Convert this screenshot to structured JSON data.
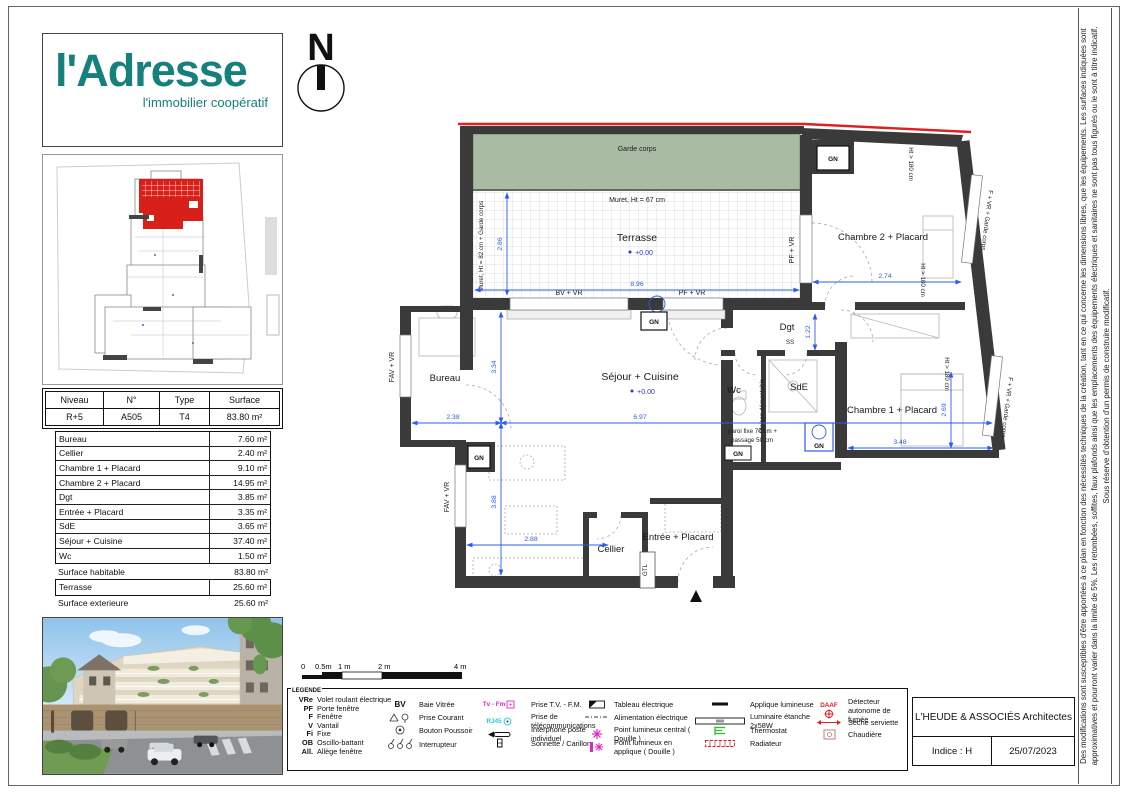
{
  "logo": {
    "name": "l'Adresse",
    "tagline": "l'immobilier coopératif"
  },
  "north_label": "N",
  "unit": {
    "headers": [
      "Niveau",
      "N°",
      "Type",
      "Surface"
    ],
    "values": [
      "R+5",
      "A505",
      "T4",
      "83.80 m²"
    ]
  },
  "areas": {
    "rows": [
      {
        "label": "Bureau",
        "value": "7.60 m²"
      },
      {
        "label": "Cellier",
        "value": "2.40 m²"
      },
      {
        "label": "Chambre 1 + Placard",
        "value": "9.10 m²"
      },
      {
        "label": "Chambre 2 + Placard",
        "value": "14.95 m²"
      },
      {
        "label": "Dgt",
        "value": "3.85 m²"
      },
      {
        "label": "Entrée + Placard",
        "value": "3.35 m²"
      },
      {
        "label": "SdE",
        "value": "3.65 m²"
      },
      {
        "label": "Séjour + Cuisine",
        "value": "37.40 m²"
      },
      {
        "label": "Wc",
        "value": "1.50 m²"
      }
    ],
    "habitable": {
      "label": "Surface habitable",
      "value": "83.80 m²"
    },
    "terrasse": {
      "label": "Terrasse",
      "value": "25.60 m²"
    },
    "exterieure": {
      "label": "Surface exterieure",
      "value": "25.60 m²"
    }
  },
  "plan": {
    "rooms": {
      "terrasse": "Terrasse",
      "sejour": "Séjour + Cuisine",
      "bureau": "Bureau",
      "chambre2": "Chambre 2 + Placard",
      "chambre1": "Chambre 1 + Placard",
      "dgt": "Dgt",
      "wc": "Wc",
      "sde": "SdE",
      "cellier": "Cellier",
      "entree": "Entrée + Placard"
    },
    "levels": {
      "terrasse": "+0.00",
      "sejour": "+0.00"
    },
    "annotations": {
      "garde_corps": "Garde corps",
      "muret67": "Muret, Ht = 67 cm",
      "muret82": "Muret, Ht = 82 cm + Garde corps",
      "bv_vr": "BV + VR",
      "pf_vr": "PF + VR",
      "fav_vr": "FAV + VR",
      "f_vr_gc": "F + VR + Garde corps",
      "ht180": "Ht > 180 cm",
      "gn": "GN",
      "gtl": "GTL",
      "ss": "SS",
      "cloison": "Cloison démontable",
      "paroi1": "paroi fixe 70 cm +",
      "paroi2": "passage 50 cm"
    },
    "dims": {
      "terrasse_h": "2.86",
      "terrasse_w": "8.96",
      "bureau_w": "2.38",
      "sejour_h1": "3.34",
      "sejour_w": "6.97",
      "sejour_h2": "3.88",
      "kitchen_w": "2.88",
      "chambre2_w": "2.74",
      "dgt_h": "1.22",
      "chambre1_w": "3.48",
      "chambre1_h": "2.69"
    }
  },
  "scalebar": {
    "t0": "0",
    "t05": "0.5m",
    "t1": "1 m",
    "t2": "2 m",
    "t4": "4 m"
  },
  "legend": {
    "title": "LEGENDE",
    "abbreviations": [
      {
        "abbr": "VRe",
        "label": "Volet roulant électrique"
      },
      {
        "abbr": "PF",
        "label": "Porte fenêtre"
      },
      {
        "abbr": "F",
        "label": "Fenêtre"
      },
      {
        "abbr": "V",
        "label": "Vantail"
      },
      {
        "abbr": "Fi",
        "label": "Fixe"
      },
      {
        "abbr": "OB",
        "label": "Oscillo-battant"
      },
      {
        "abbr": "All.",
        "label": "Allège fenêtre"
      }
    ],
    "col2": [
      {
        "sym": "BV",
        "label": "Baie Vitrée"
      },
      {
        "sym": "",
        "label": "Prise Courant"
      },
      {
        "sym": "",
        "label": "Bouton Poussoir"
      },
      {
        "sym": "",
        "label": "Interrupteur"
      }
    ],
    "col3": [
      {
        "sym": "Tv - Fm",
        "label": "Prise T.V. - F.M."
      },
      {
        "sym": "RJ45",
        "label": "Prise de télécommunications"
      },
      {
        "sym": "",
        "label": "Interphone poste individuel"
      },
      {
        "sym": "",
        "label": "Sonnette / Carillon"
      }
    ],
    "col4": [
      {
        "label": "Tableau électrique"
      },
      {
        "label": "Alimentation électrique"
      },
      {
        "label": "Point lumineux central ( Douille )"
      },
      {
        "label": "Point lumineux en applique ( Douille )"
      }
    ],
    "col5": [
      {
        "label": "Applique lumineuse"
      },
      {
        "label": "Luminaire étanche 2x58W"
      },
      {
        "label": "Thermostat"
      },
      {
        "label": "Radiateur"
      }
    ],
    "col6": [
      {
        "sym": "DAAF",
        "label": "Détecteur autonome de fumée"
      },
      {
        "sym": "",
        "label": "Sèche serviette"
      },
      {
        "sym": "",
        "label": "Chaudière"
      }
    ]
  },
  "titleblock": {
    "architect": "L'HEUDE & ASSOCIÉS Architectes",
    "indice": "Indice : H",
    "date": "25/07/2023"
  },
  "disclaimer": "Des modifications sont susceptibles d'être apportées à ce plan en fonction des nécessités techniques de la création, tant en ce qui concerne les dimensions libres, que les équipements. Les surfaces indiquées sont approximatives et pourront varier dans la limite de 5%. Les retombées, soffites, faux plafonds ainsi que les emplacements des équipements électriques et sanitaires ne sont pas tous figurés ou le sont à titre indicatif. Sous réserve d'obtention d'un permis de construire modificatif."
}
